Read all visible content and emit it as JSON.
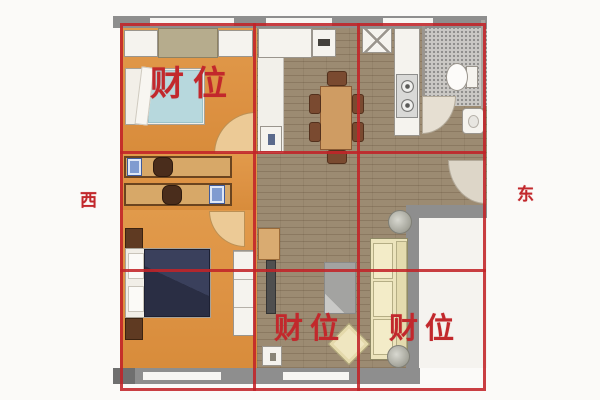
{
  "image": {
    "kind": "feng-shui apartment floor plan with nine-palace wealth-position overlay",
    "background_color": "#fbfaf8"
  },
  "annotations": {
    "wealth_label_bedroom": "财位",
    "wealth_label_living": "财位",
    "wealth_label_balcony": "财位",
    "direction_west": "西",
    "direction_east": "东",
    "annotation_color": "#c2282c",
    "grid_color": "#c12328",
    "grid_type": "3x3 overlay, outer border plus two vertical and two horizontal lines"
  },
  "floorplan": {
    "wall_color": "#8e8e8e",
    "rooms": [
      {
        "name": "bedroom-top-left",
        "floor_color": "#dd9243"
      },
      {
        "name": "study-corridor",
        "floor_color": "#dd9243"
      },
      {
        "name": "bedroom-bottom-left",
        "floor_color": "#dd9243"
      },
      {
        "name": "dining-area",
        "floor_color": "#9c8b72"
      },
      {
        "name": "kitchen",
        "floor_color": "#9c8b72"
      },
      {
        "name": "bathroom",
        "floor_color": "#cac8c4"
      },
      {
        "name": "living-room",
        "floor_color": "#9c8b72"
      },
      {
        "name": "balcony",
        "floor_color": "#f5f3ef"
      }
    ],
    "furniture_icons": [
      "wardrobe",
      "cabinet",
      "single-bed",
      "double-bed",
      "desk",
      "computer",
      "chair",
      "nightstand",
      "closet",
      "washing-machine",
      "fridge",
      "dining-table",
      "kitchen-sink",
      "stove",
      "toilet",
      "wash-basin",
      "tv",
      "rug",
      "sofa",
      "plant",
      "coffee-table",
      "shoe-cabinet",
      "door-arc"
    ]
  }
}
